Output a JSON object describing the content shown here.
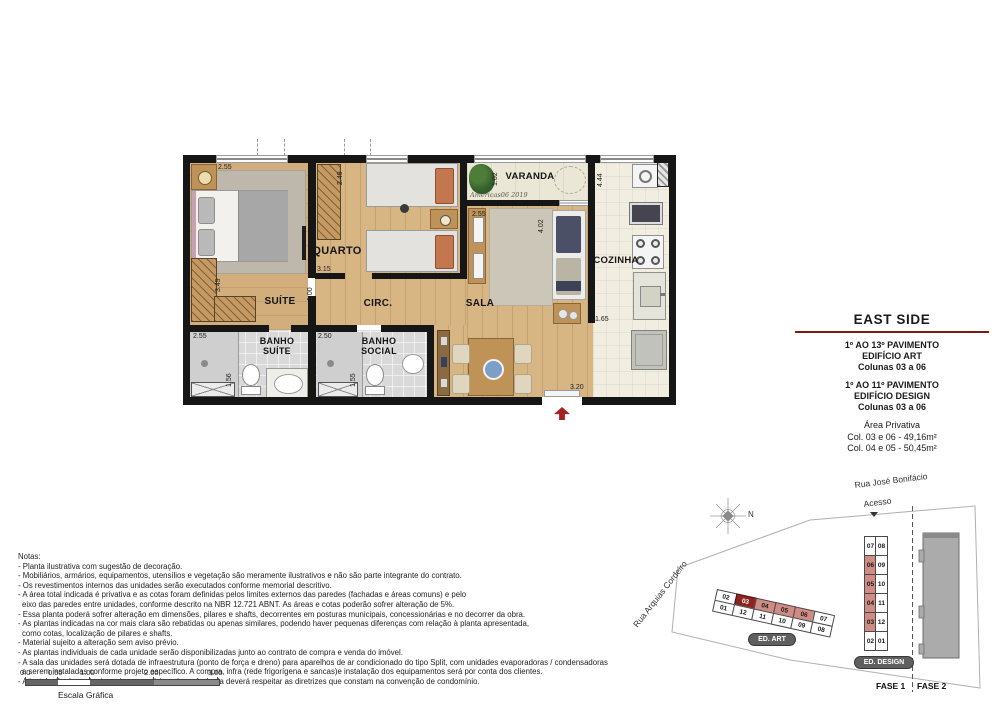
{
  "floor_plan": {
    "rooms": {
      "suite": "SUÍTE",
      "quarto": "QUARTO",
      "circ": "CIRC.",
      "sala": "SALA",
      "varanda": "VARANDA",
      "cozinha": "COZINHA",
      "banho_suite_1": "BANHO",
      "banho_suite_2": "SUÍTE",
      "banho_social_1": "BANHO",
      "banho_social_2": "SOCIAL"
    },
    "dims": {
      "suite_w": "2.55",
      "suite_h": "3.49",
      "quarto_w": "2.49",
      "quarto_d": "3.15",
      "circ_w": "1.00",
      "sala_w": "2.55",
      "sala_h": "4.02",
      "varanda_d": "1.02",
      "cozinha_h": "4.44",
      "cozinha_w": "1.65",
      "banho_suite_w": "2.55",
      "banho_suite_h": "1.56",
      "banho_social_w": "2.50",
      "banho_social_h": "1.55",
      "entrada_w": "3.20"
    },
    "signature": "Americas06 2019"
  },
  "title_block": {
    "title": "EAST SIDE",
    "building1": [
      "1º AO 13º PAVIMENTO",
      "EDIFÍCIO ART",
      "Colunas 03 a 06"
    ],
    "building2": [
      "1º AO 11º PAVIMENTO",
      "EDIFÍCIO DESIGN",
      "Colunas 03 a 06"
    ],
    "area": [
      "Área Privativa",
      "Col. 03 e 06 - 49,16m²",
      "Col. 04 e 05 - 50,45m²"
    ],
    "accent_color": "#7d1a10"
  },
  "notes": {
    "heading": "Notas:",
    "items": [
      "- Planta ilustrativa com sugestão de decoração.",
      "- Mobiliários, armários, equipamentos, utensílios e vegetação são meramente ilustrativos e não são parte integrante do contrato.",
      "- Os revestimentos internos das unidades serão executados conforme memorial descritivo.",
      "- A área total indicada é privativa e as cotas foram definidas pelos limites externos das paredes (fachadas e áreas comuns) e pelo",
      "eixo das paredes entre unidades, conforme descrito na NBR 12.721 ABNT. As áreas e cotas poderão sofrer alteração de 5%.",
      "- Essa planta poderá sofrer alteração em dimensões, pilares e shafts, decorrentes em posturas municipais, concessionárias e no decorrer da obra.",
      "- As plantas indicadas na cor mais clara são rebatidas ou apenas similares, podendo haver pequenas diferenças com relação à planta apresentada,",
      "como cotas, localização de pilares e shafts.",
      "- Material sujeito a alteração sem aviso prévio.",
      "- As plantas individuais de cada unidade serão disponibilizadas junto ao contrato de compra e venda do imóvel.",
      "- A sala das unidades será dotada de infraestrutura (ponto de força e dreno) para aparelhos de ar condicionado do tipo Split, com unidades evaporadoras / condensadoras",
      "a serem instaladas conforme projeto específico. A compra, infra (rede frigorígena e sancas)e instalação dos equipamentos será por conta dos clientes.",
      "- A instalação das máquinas de ar condicionado na fachada deverá respeitar as diretrizes que constam na convenção de condomínio."
    ]
  },
  "scale_bar": {
    "ticks": [
      "0.0",
      "0.50",
      "1.00",
      "2.00",
      "3.00"
    ],
    "label": "Escala Gráfica"
  },
  "site_map": {
    "street_top": "Rua José Bonifácio",
    "street_left": "Rua Arquias Cordeiro",
    "access": "Acesso",
    "north": "N",
    "ed_art": {
      "label": "ED. ART",
      "top_row": [
        "02",
        "03",
        "04",
        "05",
        "06",
        "07"
      ],
      "bottom_row": [
        "01",
        "12",
        "11",
        "10",
        "09",
        "08"
      ]
    },
    "ed_design": {
      "label": "ED. DESIGN",
      "left_col": [
        "07",
        "06",
        "05",
        "04",
        "03",
        "02"
      ],
      "right_col": [
        "08",
        "09",
        "10",
        "11",
        "12",
        "01"
      ]
    },
    "phase1": "FASE 1",
    "phase2": "FASE 2",
    "highlight": {
      "selected_unit": "03",
      "mirrored_units": [
        "04",
        "05",
        "06"
      ],
      "selected_color": "#8e2420",
      "mirrored_color": "#d08b85"
    }
  },
  "colors": {
    "wall": "#161616",
    "wood_floor": "#d8b684",
    "kitchen_tile": "#f1eee1",
    "entrance_arrow": "#a32222",
    "title_rule": "#7d1a10"
  }
}
